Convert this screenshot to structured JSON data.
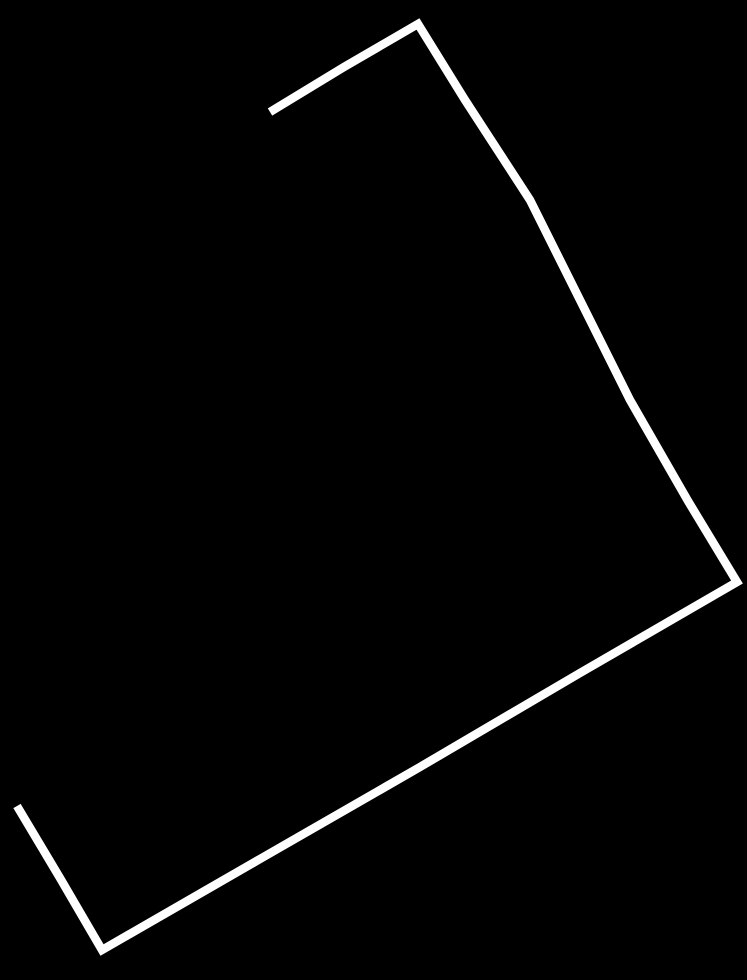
{
  "canvas": {
    "width": 747,
    "height": 980,
    "background_color": "#000000"
  },
  "sketch": {
    "shape_name": "hand-drawn-open-quadrilateral",
    "description": "single white freehand stroke outlining a rotated rectangle with an open gap on the upper-left side",
    "stroke_color": "#ffffff",
    "stroke_width": 8.5,
    "stroke_linecap": "butt",
    "stroke_linejoin": "miter",
    "points": [
      [
        270,
        112
      ],
      [
        344,
        67
      ],
      [
        418,
        24
      ],
      [
        465,
        100
      ],
      [
        530,
        200
      ],
      [
        580,
        300
      ],
      [
        630,
        400
      ],
      [
        688,
        501
      ],
      [
        737,
        582
      ],
      [
        580,
        673
      ],
      [
        420,
        767
      ],
      [
        260,
        859
      ],
      [
        102,
        950
      ],
      [
        60,
        878
      ],
      [
        17,
        806
      ]
    ]
  }
}
